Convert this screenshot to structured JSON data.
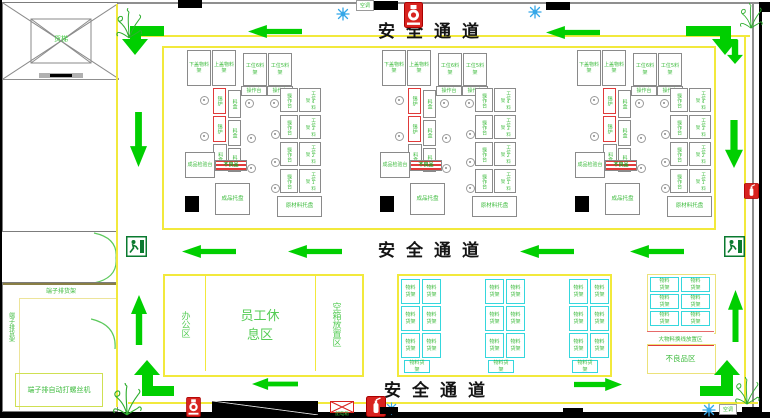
{
  "aisle_label": "安全通道",
  "elevator_label": "货梯",
  "terminal_room": {
    "rack_top": "端子排货架",
    "rack_side": "端子排货架",
    "screw_machine": "端子排自动打螺丝机"
  },
  "zones": {
    "office": "办公区",
    "rest": "员工休息区",
    "empty_box": "空箱放置区",
    "storage_box": "物料货架",
    "changeover": "大物料换线放置区",
    "defective": "不良品区"
  },
  "cluster": {
    "rack_bottom_cover": "下盖物料架",
    "rack_top_cover": "上盖物料架",
    "rack_ws6": "工位6料架",
    "rack_ws5": "工位5料架",
    "op_station": "操作台",
    "solder_pot": "锡炉",
    "bin": "料盒",
    "inspection": "成品检验台",
    "reject_strip": "不良品",
    "pallet_finished": "成品托盘",
    "pallet_raw": "原材料托盘",
    "right_rows": [
      {
        "op": "操作台",
        "rack": "工位4料架"
      },
      {
        "op": "操作台",
        "rack": "工位3料架"
      },
      {
        "op": "操作台",
        "rack": "工位2料架"
      },
      {
        "op": "操作台",
        "rack": "工位1料架"
      }
    ]
  },
  "labels": {
    "ac": "空调",
    "power_box": "配电箱"
  },
  "icons": {
    "fire_hydrant": "hydrant-icon",
    "fire_extinguisher": "extinguisher-icon",
    "emergency_exit": "exit-running-man-icon",
    "air_conditioner": "snowflake-icon",
    "plant": "plant-icon",
    "power_box": "crossed-box-icon",
    "seat": "stool-circle-icon"
  },
  "colors": {
    "aisle_line": "#f2e93c",
    "arrow_green": "#00cf00",
    "label_green": "#3dbb3d",
    "rack_cyan": "#35d7dd",
    "alert_red": "#e03a3a",
    "text_black": "#141414"
  }
}
